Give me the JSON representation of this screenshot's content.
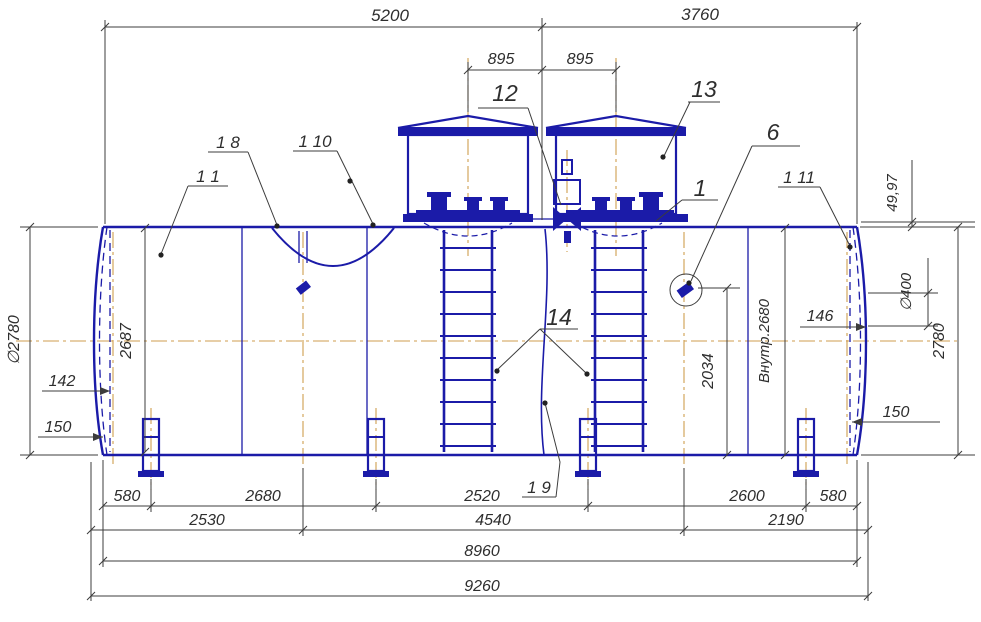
{
  "drawing": {
    "type": "horizontal-tank-assembly",
    "colors": {
      "part_line": "#1b1ba8",
      "dimension_line": "#3c3c3c",
      "center_line": "#cf9e4f",
      "background": "#ffffff"
    },
    "dims": {
      "top_shell_left": "5200",
      "top_shell_right": "3760",
      "hatch_pitch_left": "895",
      "hatch_pitch_right": "895",
      "head_rise": "49,97",
      "diam_overall_left": "∅2780",
      "internal_height": "2687",
      "head_inset_left": "142",
      "support_height_left": "150",
      "nozzle_diam": "∅400",
      "diam_overall_right": "2780",
      "head_inset_right": "146",
      "support_height_right": "150",
      "internal_diam": "Внутр.2680",
      "fitting_elevation": "2034",
      "row1": [
        "580",
        "2680",
        "2520",
        "2600",
        "580"
      ],
      "row2": [
        "2530",
        "4540",
        "2190"
      ],
      "shell_length": "8960",
      "overall_length": "9260"
    },
    "callouts": {
      "c12": "12",
      "c13": "13",
      "c6": "6",
      "c1": "1",
      "c14": "14",
      "s1_1": "1 1",
      "s1_8": "1 8",
      "s1_9": "1 9",
      "s1_10": "1 10",
      "s1_11": "1 11"
    }
  }
}
